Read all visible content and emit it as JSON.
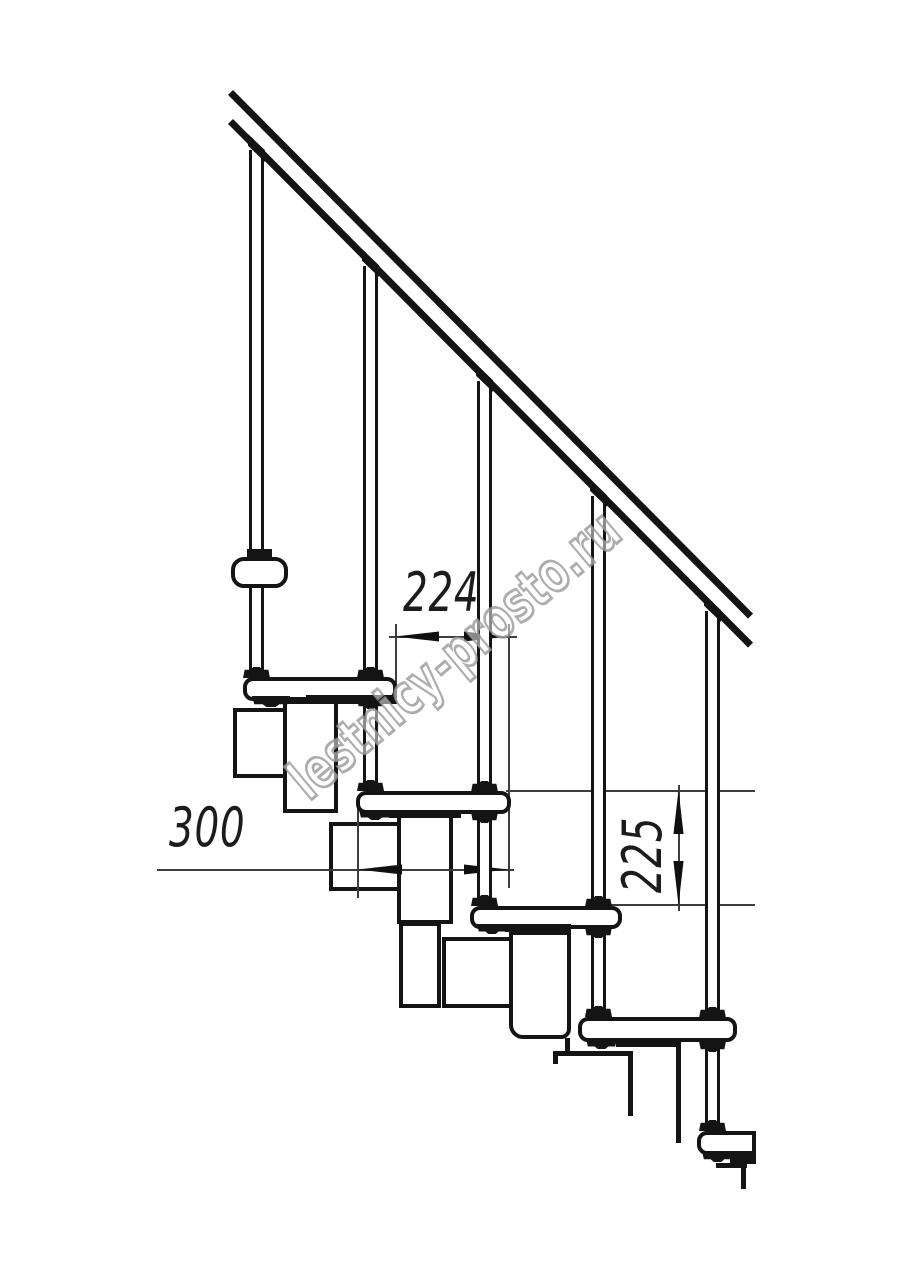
{
  "drawing": {
    "title": "modular staircase side elevation",
    "watermark": {
      "text": "lestnicy-prosto.ru"
    },
    "dimensions": {
      "step_run": {
        "value": "224"
      },
      "tread_depth": {
        "value": "300"
      },
      "step_rise": {
        "value": "225"
      }
    },
    "colors": {
      "line": "#141414",
      "dimension_line": "#3d3d3d",
      "watermark_stroke": "#969696",
      "background": "#ffffff"
    }
  }
}
